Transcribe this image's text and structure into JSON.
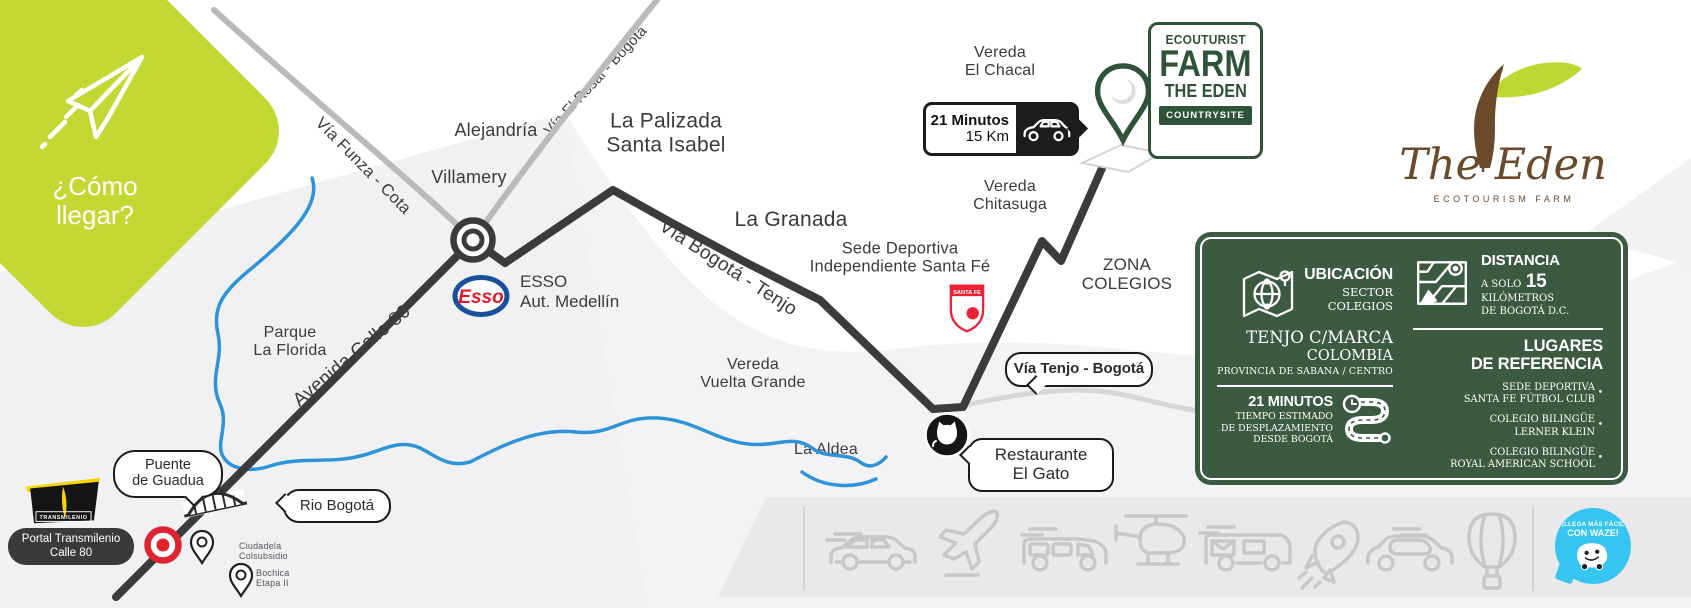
{
  "header": {
    "como_llegar": "¿Cómo\nllegar?"
  },
  "map_labels": {
    "via_funza_cota": "Vía Funza - Cota",
    "via_el_rosal_bogota": "Vía El Rosal - Bogotá",
    "alejandria": "Alejandría",
    "villamery": "Villamery",
    "la_palizada": "La Palizada\nSanta Isabel",
    "la_granada": "La Granada",
    "via_bogota_tenjo": "Vía Bogotá - Tenjo",
    "vereda_el_chacal": "Vereda\nEl Chacal",
    "vereda_chitasuga": "Vereda\nChitasuga",
    "sede_deportiva": "Sede Deportiva\nIndependiente Santa Fé",
    "zona_colegios": "ZONA\nCOLEGIOS",
    "vereda_vuelta_grande": "Vereda\nVuelta Grande",
    "la_aldea": "La Aldea",
    "parque_la_florida": "Parque\nLa Florida",
    "avenida_calle_80": "Avenida Calle 80",
    "ciudadela_colsubsidio": "Ciudadela\nColsubsidio",
    "bochica_etapa_ii": "Bochica\nEtapa II"
  },
  "callouts": {
    "puente_de_guadua": "Puente\nde Guadua",
    "rio_bogota": "Rio Bogotá",
    "via_tenjo_bogota": "Vía Tenjo - Bogotá",
    "restaurante_el_gato": "Restaurante\nEl Gato",
    "portal_transmilenio": "Portal Transmilenio\nCalle 80"
  },
  "esso": {
    "logo_text": "Esso",
    "name": "ESSO",
    "subtitle": "Aut. Medellín"
  },
  "santa_fe": {
    "shield_text": "SANTA FE"
  },
  "transmilenio": {
    "brand": "TRANSMILENIO"
  },
  "time_badge": {
    "minutes": "21 Minutos",
    "distance": "15 Km"
  },
  "farm_badge": {
    "line1": "ECOUTURIST",
    "line2": "FARM",
    "line3": "THE EDEN",
    "tag": "COUNTRYSITE"
  },
  "brand_logo": {
    "script": "The Eden",
    "subtitle": "ECOTOURISM FARM"
  },
  "info_panel": {
    "ubicacion": {
      "title": "UBICACIÓN",
      "subtitle": "SECTOR\nCOLEGIOS",
      "place": "TENJO C/MARCA",
      "country": "COLOMBIA",
      "province": "PROVINCIA DE SABANA / CENTRO"
    },
    "tiempo": {
      "title": "21 MINUTOS",
      "subtitle": "TIEMPO ESTIMADO\nDE DESPLAZAMIENTO\nDESDE BOGOTÁ"
    },
    "distancia": {
      "title": "DISTANCIA",
      "prefix": "A SOLO",
      "value": "15",
      "suffix": "KILÓMETROS\nDE BOGOTÁ D.C."
    },
    "lugares": {
      "title": "LUGARES\nDE REFERENCIA",
      "items": [
        "SEDE DEPORTIVA\nSANTA FE FÚTBOL CLUB",
        "COLEGIO BILINGÜE\nLERNER KLEIN",
        "COLEGIO BILINGÜE\nROYAL AMERICAN SCHOOL"
      ]
    }
  },
  "waze": {
    "line1": "¡LLEGA MÁS FÁCIL",
    "line2": "CON WAZE!"
  },
  "colors": {
    "lime": "#c3d832",
    "dark_green": "#2f5337",
    "panel_green": "#3c5a40",
    "route_black": "#3b3b3d",
    "road_gray": "#b9babc",
    "river_blue": "#2e93d8",
    "santa_fe_red": "#ed2236",
    "esso_blue": "#1a4f9c",
    "esso_red": "#e3192c",
    "waze_blue": "#35c5f0",
    "transmilenio_yellow": "#f7d500",
    "brand_brown": "#6b4a2b"
  }
}
